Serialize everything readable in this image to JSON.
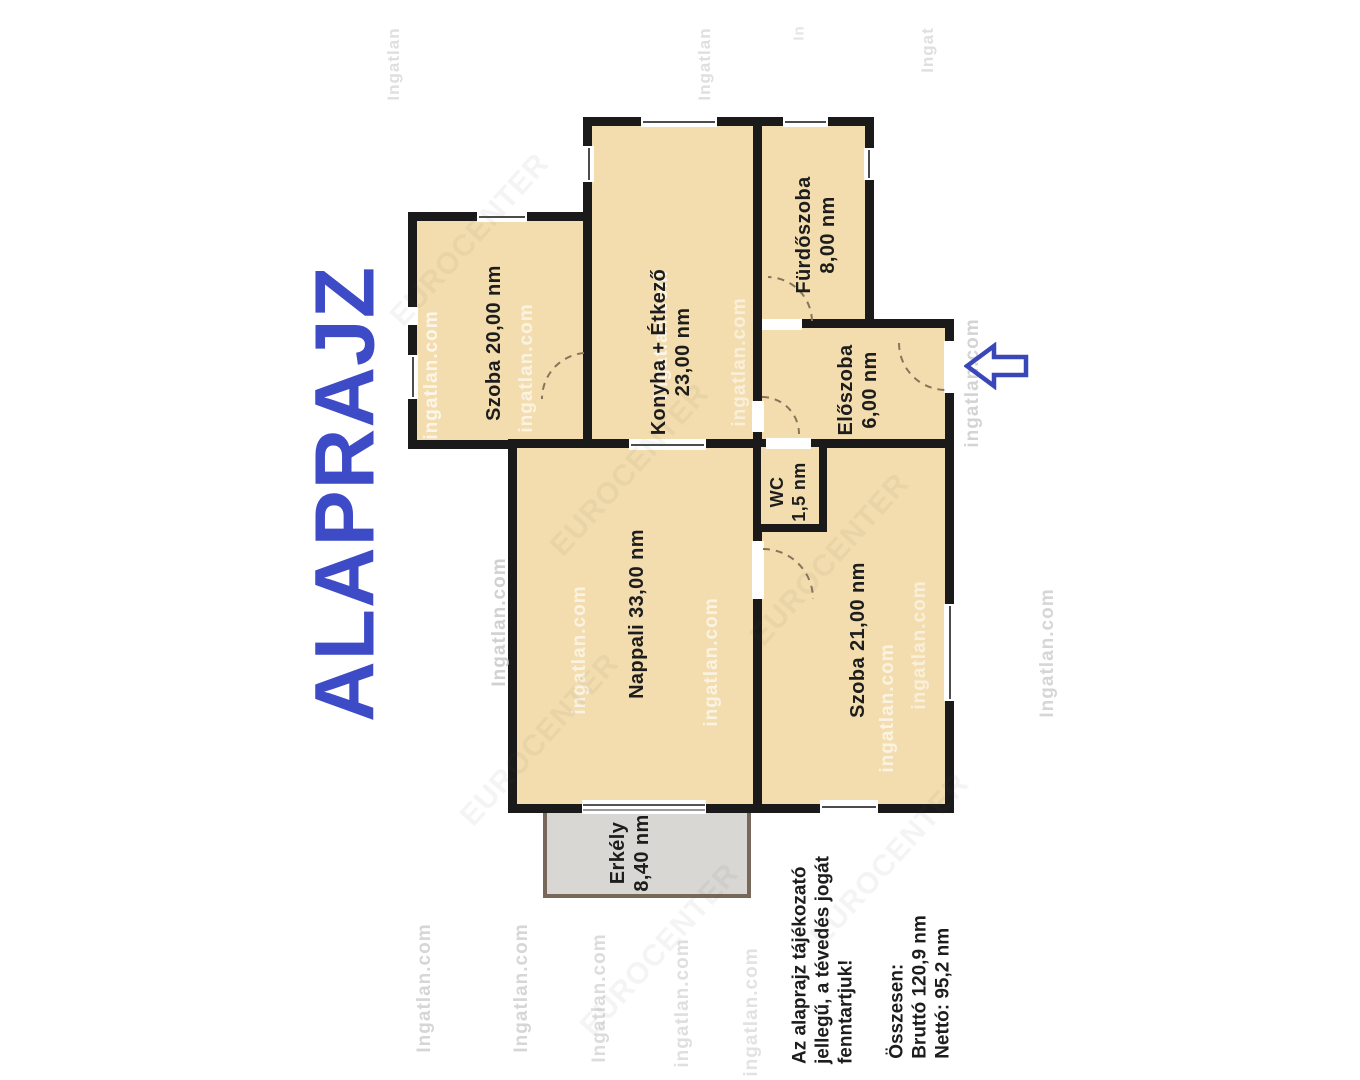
{
  "title": "ALAPRAJZ",
  "rooms": {
    "szoba20": {
      "label": "Szoba 20,00 nm"
    },
    "konyha": {
      "name": "Konyha + Étkező",
      "area": "23,00 nm"
    },
    "furdoszoba": {
      "name": "Fürdőszoba",
      "area": "8,00 nm"
    },
    "eloszoba": {
      "name": "Előszoba",
      "area": "6,00 nm"
    },
    "wc": {
      "name": "WC",
      "area": "1,5 nm"
    },
    "nappali": {
      "label": "Nappali 33,00 nm"
    },
    "szoba21": {
      "label": "Szoba 21,00 nm"
    },
    "erkely": {
      "name": "Erkély",
      "area": "8,40 nm"
    }
  },
  "disclaimer": {
    "line1": "Az alaprajz tájékozató",
    "line2": "jellegű, a tévedés jogát",
    "line3": "fenntartjuk!"
  },
  "totals": {
    "heading": "Összesen:",
    "brutto": "Bruttó 120,9 nm",
    "netto": "Nettó: 95,2 nm"
  },
  "colors": {
    "room_fill": "#F3DDAE",
    "wall": "#1a1a1a",
    "balcony_fill": "#D8D7D3",
    "balcony_border": "#77695A",
    "accent_blue": "#3D4BC7",
    "arrow_blue": "#3A47B8",
    "watermark_gray": "#c6c6c6"
  },
  "icons": {
    "entrance_arrow": "left-arrow"
  },
  "watermarks": [
    {
      "t": "Ingatlan",
      "x": 394,
      "y": 64,
      "o": 0.55,
      "r": -90,
      "c": "gray",
      "s": 17
    },
    {
      "t": "Ingatlan",
      "x": 705,
      "y": 64,
      "o": 0.55,
      "r": -90,
      "c": "gray",
      "s": 17
    },
    {
      "t": "In",
      "x": 799,
      "y": 33,
      "o": 0.45,
      "r": -90,
      "c": "gray",
      "s": 15
    },
    {
      "t": "Ingat",
      "x": 928,
      "y": 50,
      "o": 0.55,
      "r": -90,
      "c": "gray",
      "s": 17
    },
    {
      "t": "ingatlan.com",
      "x": 432,
      "y": 375,
      "o": 0.75,
      "r": -90,
      "c": "light",
      "s": 19
    },
    {
      "t": "ingatlan.com",
      "x": 527,
      "y": 368,
      "o": 0.65,
      "r": -90,
      "c": "light",
      "s": 19
    },
    {
      "t": "Ingatlan.com",
      "x": 662,
      "y": 335,
      "o": 0.75,
      "r": -90,
      "c": "light",
      "s": 19
    },
    {
      "t": "ingatlan.com",
      "x": 740,
      "y": 362,
      "o": 0.55,
      "r": -90,
      "c": "light",
      "s": 19
    },
    {
      "t": "ingatlan.com",
      "x": 973,
      "y": 383,
      "o": 0.75,
      "r": -90,
      "c": "gray",
      "s": 19
    },
    {
      "t": "Ingatlan.com",
      "x": 500,
      "y": 622,
      "o": 0.8,
      "r": -90,
      "c": "gray",
      "s": 19
    },
    {
      "t": "ingatlan.com",
      "x": 580,
      "y": 650,
      "o": 0.65,
      "r": -90,
      "c": "light",
      "s": 19
    },
    {
      "t": "ingatlan.com",
      "x": 712,
      "y": 662,
      "o": 0.65,
      "r": -90,
      "c": "light",
      "s": 19
    },
    {
      "t": "ingatlan.com",
      "x": 888,
      "y": 708,
      "o": 0.65,
      "r": -90,
      "c": "light",
      "s": 19
    },
    {
      "t": "ingatlan.com",
      "x": 920,
      "y": 645,
      "o": 0.55,
      "r": -90,
      "c": "light",
      "s": 19
    },
    {
      "t": "Ingatlan.com",
      "x": 1048,
      "y": 653,
      "o": 0.7,
      "r": -90,
      "c": "gray",
      "s": 19
    },
    {
      "t": "Ingatlan.com",
      "x": 425,
      "y": 988,
      "o": 0.7,
      "r": -90,
      "c": "gray",
      "s": 19
    },
    {
      "t": "Ingatlan.com",
      "x": 522,
      "y": 988,
      "o": 0.7,
      "r": -90,
      "c": "gray",
      "s": 19
    },
    {
      "t": "Ingatlan.com",
      "x": 600,
      "y": 998,
      "o": 0.6,
      "r": -90,
      "c": "gray",
      "s": 19
    },
    {
      "t": "ingatlan.com",
      "x": 683,
      "y": 1003,
      "o": 0.55,
      "r": -90,
      "c": "gray",
      "s": 19
    },
    {
      "t": "ingatlan.com",
      "x": 752,
      "y": 1012,
      "o": 0.5,
      "r": -90,
      "c": "gray",
      "s": 19
    },
    {
      "t": "EUROCENTER",
      "x": 470,
      "y": 240,
      "o": 0.06,
      "r": -48,
      "c": "diag",
      "s": 30
    },
    {
      "t": "EUROCENTER",
      "x": 630,
      "y": 470,
      "o": 0.06,
      "r": -48,
      "c": "diag",
      "s": 30
    },
    {
      "t": "EUROCENTER",
      "x": 540,
      "y": 740,
      "o": 0.06,
      "r": -48,
      "c": "diag",
      "s": 30
    },
    {
      "t": "EUROCENTER",
      "x": 830,
      "y": 560,
      "o": 0.06,
      "r": -48,
      "c": "diag",
      "s": 30
    },
    {
      "t": "EUROCENTER",
      "x": 890,
      "y": 860,
      "o": 0.06,
      "r": -48,
      "c": "diag",
      "s": 30
    },
    {
      "t": "EUROCENTER",
      "x": 660,
      "y": 950,
      "o": 0.06,
      "r": -48,
      "c": "diag",
      "s": 30
    }
  ]
}
